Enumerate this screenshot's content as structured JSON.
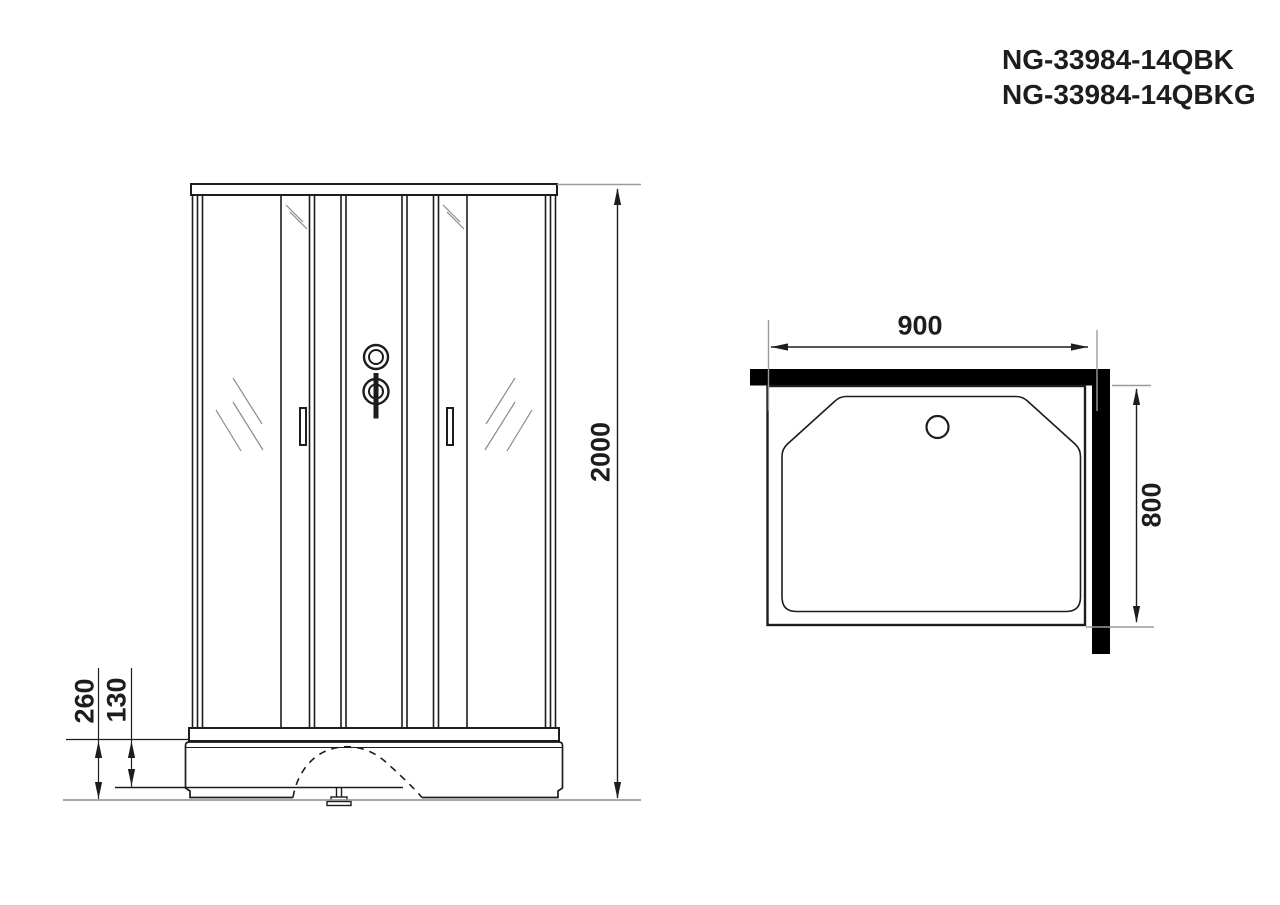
{
  "title": {
    "lines": [
      "NG-33984-14QBK",
      "NG-33984-14QBKG"
    ]
  },
  "front_view": {
    "dimensions": {
      "height": "2000",
      "base_total_height": "260",
      "base_lip_height": "130"
    }
  },
  "top_view": {
    "dimensions": {
      "width": "900",
      "depth": "800"
    }
  },
  "colors": {
    "line": "#1d1d1b",
    "hatch_line": "#8a8a8a",
    "reference_line": "#9b9b9b",
    "wall_fill": "#000000",
    "background": "#ffffff"
  }
}
